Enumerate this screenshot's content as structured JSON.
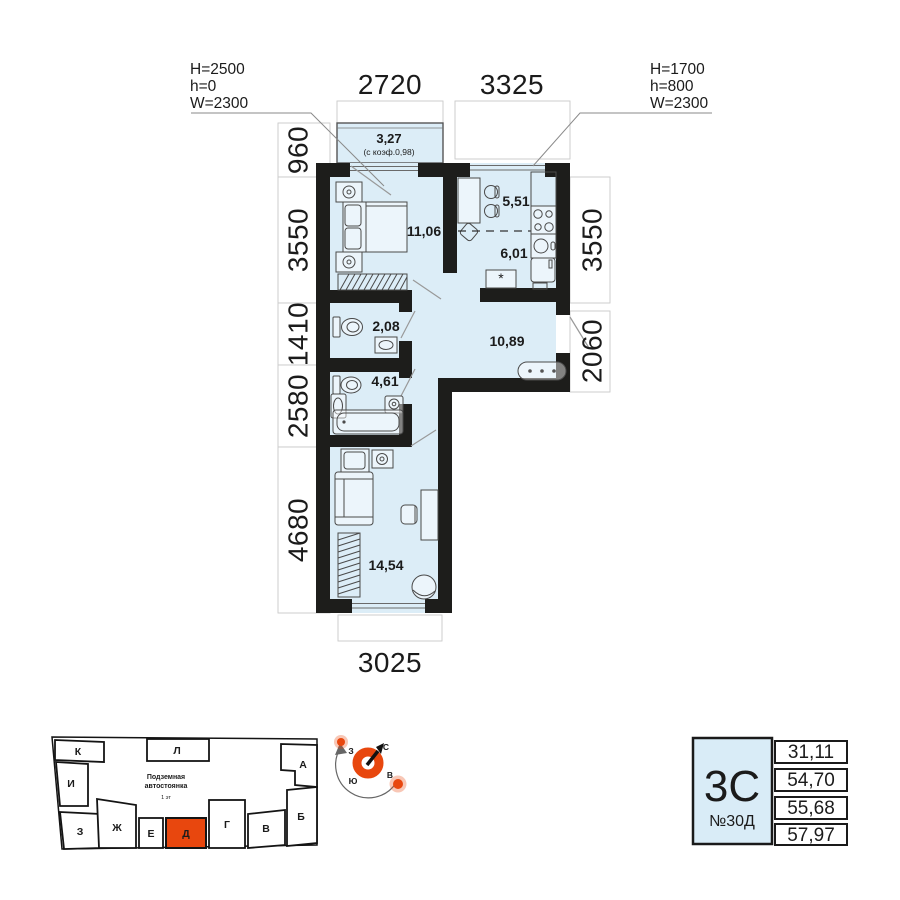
{
  "floor_plan": {
    "window_annotations": [
      {
        "lines": [
          "H=2500",
          "h=0",
          "W=2300"
        ]
      },
      {
        "lines": [
          "H=1700",
          "h=800",
          "W=2300"
        ]
      }
    ],
    "dimensions": {
      "top": [
        "2720",
        "3325"
      ],
      "left": [
        "960",
        "3550",
        "1410",
        "2580",
        "4680"
      ],
      "right": [
        "3550",
        "2060"
      ],
      "bottom": [
        "3025"
      ]
    },
    "rooms": {
      "balcony": {
        "area": "3,27",
        "coef_note": "(с коэф.0,98)"
      },
      "bedroom": {
        "area": "11,06"
      },
      "dining": {
        "area": "5,51"
      },
      "kitchen": {
        "area": "6,01"
      },
      "wc": {
        "area": "2,08"
      },
      "hallway": {
        "area": "10,89"
      },
      "bathroom": {
        "area": "4,61"
      },
      "living_room": {
        "area": "14,54"
      }
    },
    "appliance_mark": "*"
  },
  "site_plan": {
    "underground_label": [
      "Подземная",
      "автостоянка",
      "1 эт"
    ],
    "blocks": [
      {
        "label": "К"
      },
      {
        "label": "Л"
      },
      {
        "label": "А"
      },
      {
        "label": "И"
      },
      {
        "label": "З"
      },
      {
        "label": "Ж"
      },
      {
        "label": "Е"
      },
      {
        "label": "Д",
        "highlighted": true
      },
      {
        "label": "Г"
      },
      {
        "label": "В"
      },
      {
        "label": "Б"
      }
    ]
  },
  "compass": {
    "north": "С",
    "east": "В",
    "south": "Ю",
    "west": "З"
  },
  "info_card": {
    "plan_type": "3С",
    "flat_number": "№30Д",
    "areas": [
      "31,11",
      "54,70",
      "55,68",
      "57,97"
    ]
  },
  "colors": {
    "accent": "#e8470e",
    "room_fill": "#dcedf7",
    "wall": "#1d1d1b"
  }
}
